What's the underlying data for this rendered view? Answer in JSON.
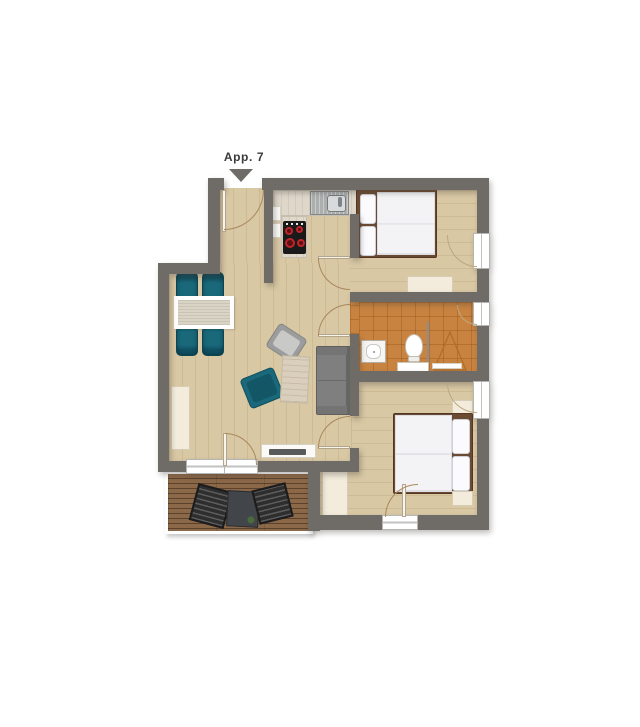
{
  "label": {
    "apartment": "App. 7"
  },
  "colors": {
    "wall": "#6f6b67",
    "floor": "#d9c8a4",
    "tile": "#c98340",
    "deck": "#8b6848",
    "deck_dark": "#5c412c",
    "teal": "#19697b",
    "teal_dark": "#0f4f60",
    "cream": "#f3ecdc",
    "cream_border": "#d8cdb4",
    "counter": "#ded7ca",
    "sofa": "#7f7f7f",
    "sofa_dark": "#676767",
    "bed_frame": "#6b4a33",
    "duvet": "#f3f3f5",
    "stove": "#1a1a1a",
    "burner": "#c0252a",
    "arc": "#a9885e",
    "lounge": "#2e2e2e",
    "linen": "#dad4c6",
    "steel": "#abafae",
    "label_ink": "#3a3a3a"
  }
}
